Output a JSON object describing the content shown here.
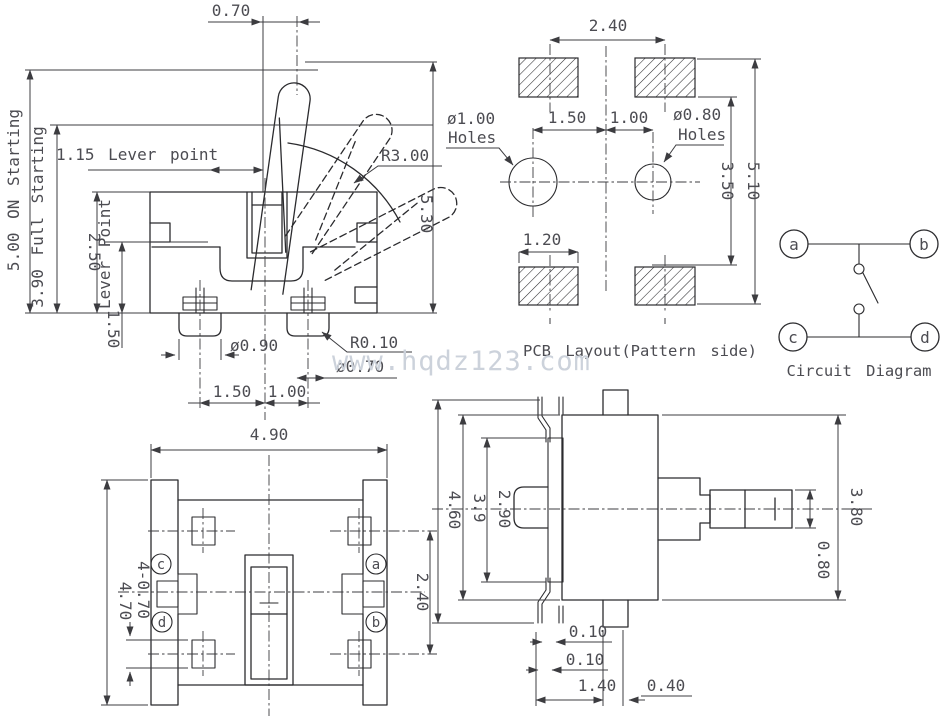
{
  "watermark": "www.hqdz123.com",
  "view_side_lever": {
    "d070": "0.70",
    "on_starting": "5.00 ON Starting",
    "full_starting": "3.90 Full Starting",
    "lever_point_h": "1.15 Lever point",
    "d250": "2.50",
    "lever_point_v": "Lever Point",
    "d150_left": "1.50",
    "r300": "R3.00",
    "d530": "5.30",
    "d090": "ø0.90",
    "r010": "R0.10",
    "d070_pin": "ø0.70",
    "d150": "1.50",
    "d100": "1.00"
  },
  "view_pcb": {
    "caption": "PCB Layout(Pattern side)",
    "d240": "2.40",
    "hole_left_dia": "ø1.00",
    "hole_left_word": "Holes",
    "d150": "1.50",
    "d100": "1.00",
    "hole_right_dia": "ø0.80",
    "hole_right_word": "Holes",
    "d350": "3.50",
    "d510": "5.10",
    "d120": "1.20"
  },
  "view_circuit": {
    "caption": "Circuit Diagram",
    "t_a": "a",
    "t_b": "b",
    "t_c": "c",
    "t_d": "d"
  },
  "view_bottom": {
    "d490": "4.90",
    "d470": "4.70",
    "d4x070": "4-0.70",
    "d240": "2.40",
    "t_a": "a",
    "t_b": "b",
    "t_c": "c",
    "t_d": "d"
  },
  "view_side2": {
    "d460": "4.60",
    "d39": "3.9",
    "d290": "2.90",
    "d380": "3.80",
    "d080": "0.80",
    "d010a": "0.10",
    "d010b": "0.10",
    "d140": "1.40",
    "d040": "0.40"
  }
}
